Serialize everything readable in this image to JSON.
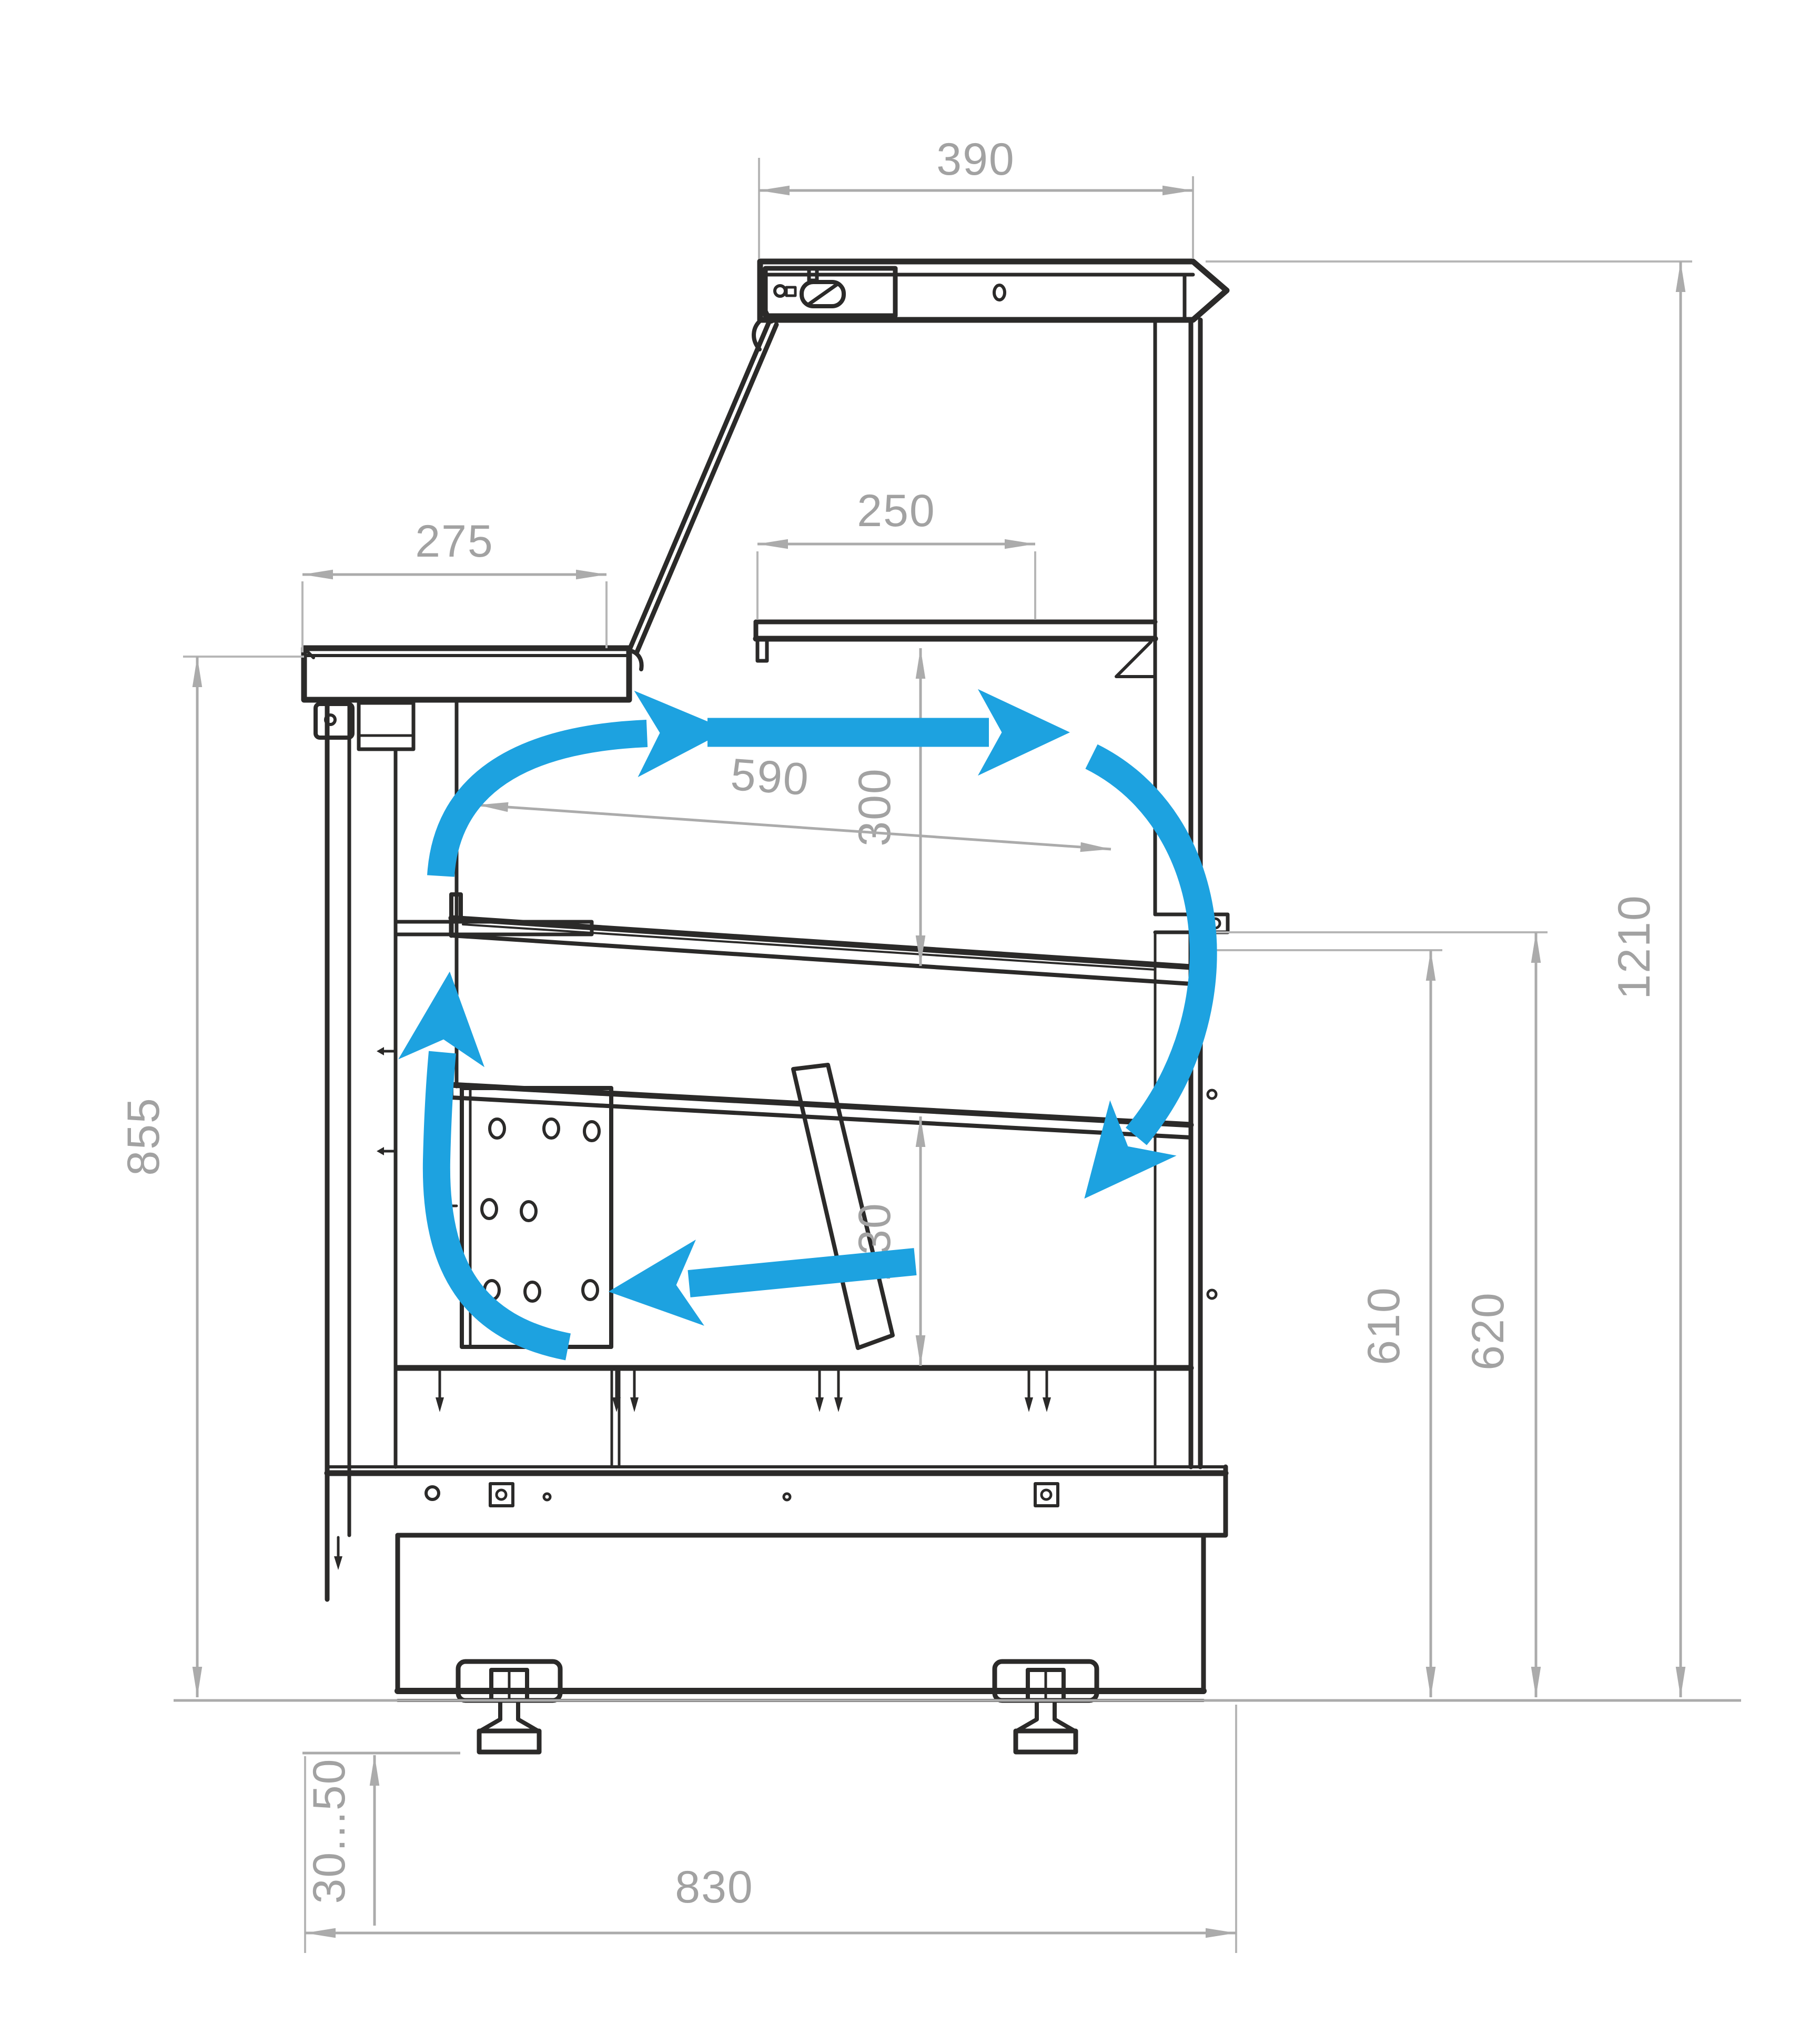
{
  "diagram": {
    "type": "technical-drawing-side-section",
    "subject": "Refrigerated serve-over display case cross-section with air circulation arrows",
    "units": "mm",
    "colors": {
      "outline": "#2b2a29",
      "dimension_lines": "#ababab",
      "dimension_text": "#a2a2a2",
      "airflow": "#1da2e0",
      "background": "#ffffff"
    },
    "dimensions": {
      "canopy_width": "390",
      "shelf_depth": "250",
      "counter_top_depth": "275",
      "shelf_to_deck_height": "300",
      "display_deck_depth": "590",
      "deck_to_well_depth": "230",
      "front_counter_height": "855",
      "rear_inner_height": "610",
      "rear_outer_height": "620",
      "overall_height": "1210",
      "foot_adjustment_range": "30...50",
      "overall_depth": "830"
    }
  }
}
